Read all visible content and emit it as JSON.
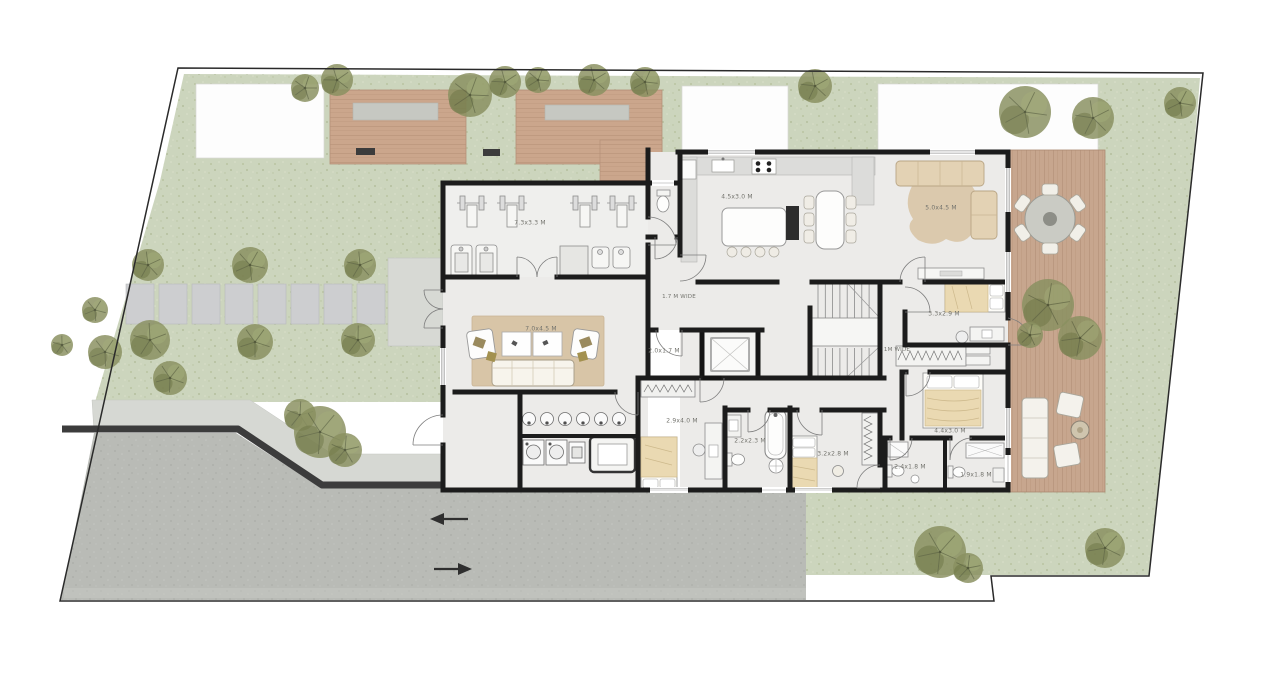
{
  "plan": {
    "type": "residential-ground-floor-plan",
    "rooms": {
      "gym": {
        "label": "7.3x3.3 M"
      },
      "kitchen_dining": {
        "label": "4.5x3.0 M"
      },
      "family_room": {
        "label": "5.0x4.5 M"
      },
      "corridor": {
        "label": "1.7 M WIDE"
      },
      "elevator_lobby": {
        "label": "2.0x1.7 M"
      },
      "living_room": {
        "label": "7.0x4.5 M"
      },
      "bedroom_1": {
        "label": "2.9x4.0 M"
      },
      "bathroom_1": {
        "label": "2.2x2.3 M"
      },
      "bedroom_2": {
        "label": "3.2x2.8 M"
      },
      "bathroom_2": {
        "label": "2.4x1.8 M"
      },
      "bathroom_3": {
        "label": "1.9x1.8 M"
      },
      "bedroom_3": {
        "label": "3.3x2.9 M"
      },
      "wardrobe_hall": {
        "label": "1M WIDE"
      },
      "master_bedroom": {
        "label": "4.4x3.0 M"
      }
    },
    "colors": {
      "grass": "#ccd5bd",
      "wood_deck": "#c9a58c",
      "wall": "#1c1c1c",
      "paving": "#b9bbb6",
      "floor": "#ecebe9",
      "rug": "#d8c5a7",
      "tree": "#8a9060",
      "blanket": "#ead9b2"
    }
  }
}
